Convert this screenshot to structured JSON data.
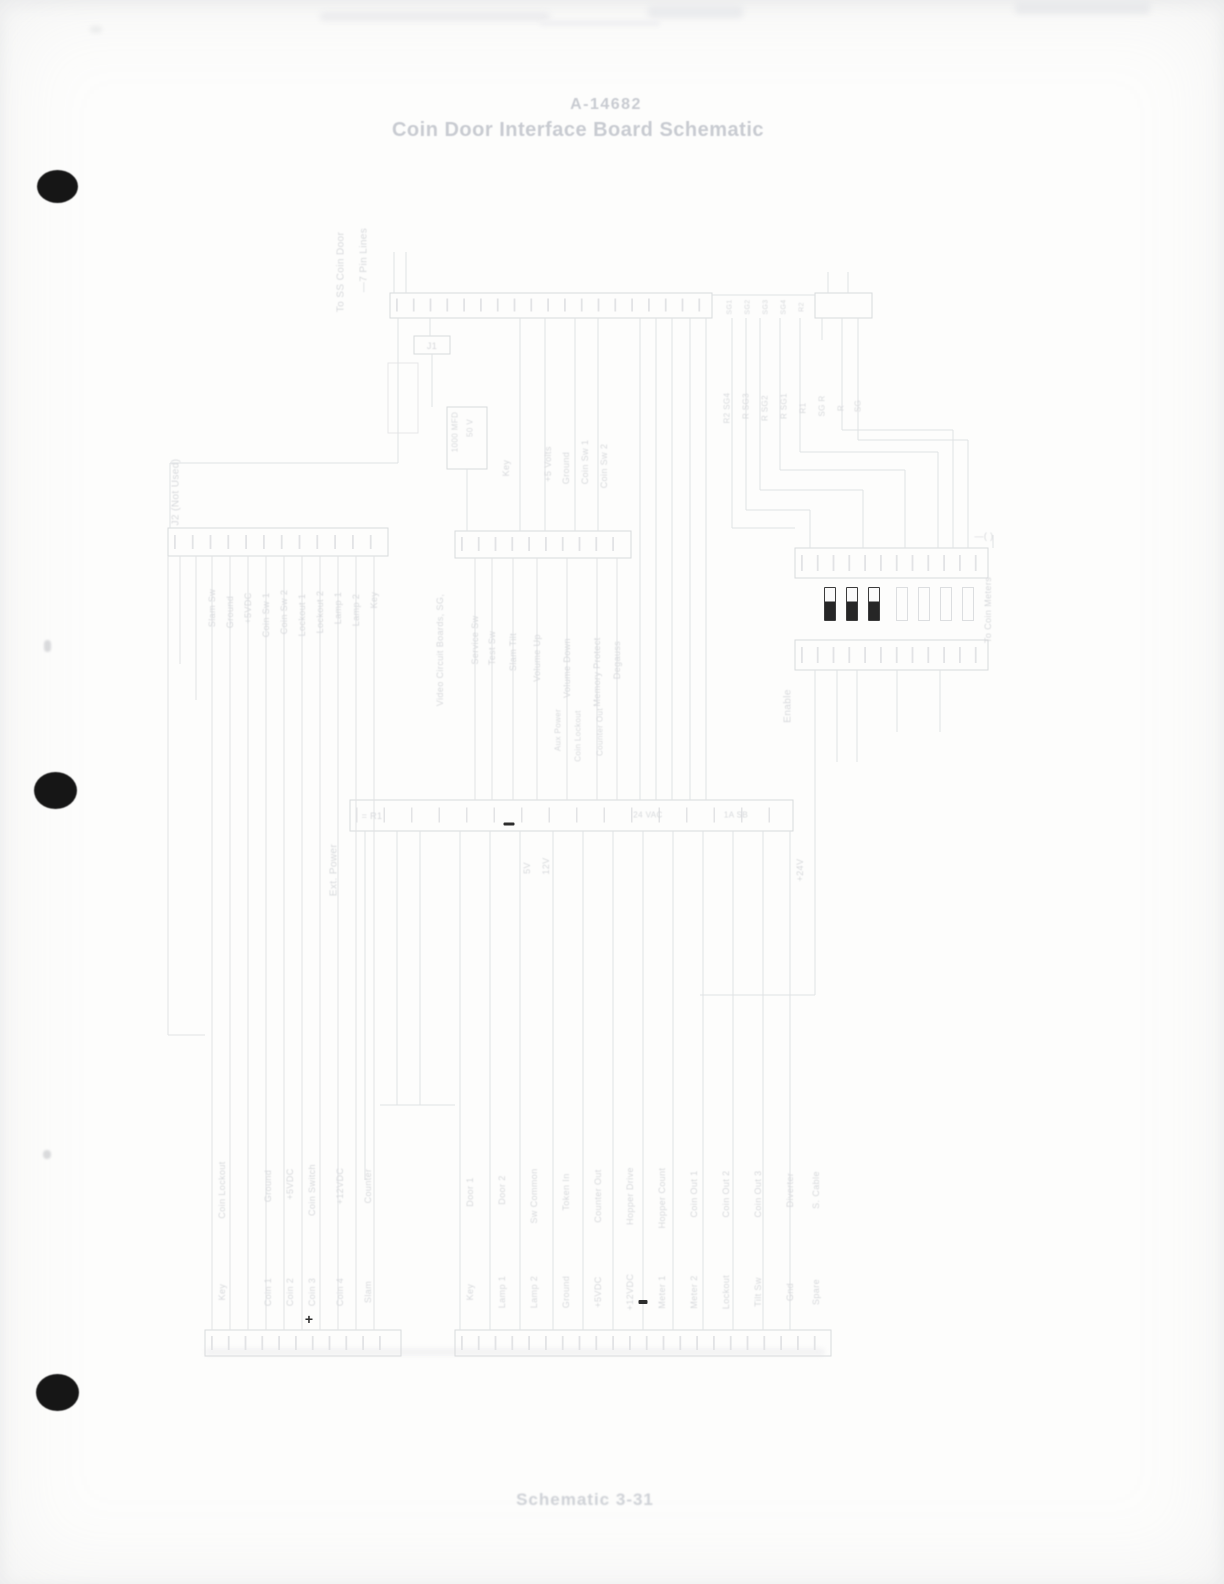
{
  "page": {
    "title_line1": "A-14682",
    "title_line2": "Coin Door Interface Board Schematic",
    "caption": "Schematic 3-31",
    "background_color": "#fdfdfc",
    "ink_color": "#dfe1e3",
    "title_color": "#c8cbd1",
    "dark_mark_color": "#2d2d2d",
    "punch_hole_color": "#161616",
    "punch_hole_count": 3
  },
  "schematic": {
    "note": "very faint scanned connector-wiring schematic, rotated wire labels",
    "jumpers": {
      "y": 587,
      "w": 10,
      "h": 32,
      "filled": [
        {
          "x": 824
        },
        {
          "x": 846
        },
        {
          "x": 868
        }
      ],
      "empty": [
        {
          "x": 896
        },
        {
          "x": 918
        },
        {
          "x": 940
        },
        {
          "x": 962
        }
      ]
    },
    "marks": [
      {
        "type": "plus",
        "x": 309,
        "y": 1319,
        "glyph": "+"
      },
      {
        "type": "dash",
        "x": 509,
        "y": 824,
        "w": 11,
        "h": 3
      },
      {
        "type": "dash",
        "x": 643,
        "y": 1302,
        "w": 9,
        "h": 4
      }
    ],
    "labels": [
      {
        "text": "To SS Coin Door",
        "x": 341,
        "y": 272,
        "size": 10
      },
      {
        "text": "—7 Pin Lines",
        "x": 364,
        "y": 260,
        "size": 10
      },
      {
        "text": "J1",
        "x": 432,
        "y": 346,
        "rot": false,
        "size": 9
      },
      {
        "text": "1000 MFD",
        "x": 455,
        "y": 432,
        "size": 8
      },
      {
        "text": "50 V",
        "x": 470,
        "y": 428,
        "size": 8
      },
      {
        "text": "Key",
        "x": 506,
        "y": 468,
        "size": 9
      },
      {
        "text": "+5 Volts",
        "x": 548,
        "y": 464,
        "size": 9
      },
      {
        "text": "Ground",
        "x": 566,
        "y": 468,
        "size": 9
      },
      {
        "text": "Coin Sw 1",
        "x": 585,
        "y": 462,
        "size": 9
      },
      {
        "text": "Coin Sw 2",
        "x": 604,
        "y": 466,
        "size": 9
      },
      {
        "text": "SG1",
        "x": 730,
        "y": 307,
        "size": 7
      },
      {
        "text": "SG2",
        "x": 748,
        "y": 307,
        "size": 7
      },
      {
        "text": "SG3",
        "x": 766,
        "y": 307,
        "size": 7
      },
      {
        "text": "SG4",
        "x": 784,
        "y": 307,
        "size": 7
      },
      {
        "text": "R2",
        "x": 802,
        "y": 307,
        "size": 7
      },
      {
        "text": "R2 SG4",
        "x": 727,
        "y": 408,
        "size": 8
      },
      {
        "text": "R SG3",
        "x": 746,
        "y": 406,
        "size": 8
      },
      {
        "text": "R SG2",
        "x": 765,
        "y": 408,
        "size": 8
      },
      {
        "text": "R SG1",
        "x": 784,
        "y": 406,
        "size": 8
      },
      {
        "text": "R1",
        "x": 803,
        "y": 408,
        "size": 8
      },
      {
        "text": "SG R",
        "x": 822,
        "y": 406,
        "size": 8
      },
      {
        "text": "R",
        "x": 841,
        "y": 408,
        "size": 8
      },
      {
        "text": "SG",
        "x": 858,
        "y": 406,
        "size": 8
      },
      {
        "text": "J2 (Not Used)",
        "x": 176,
        "y": 492,
        "size": 10
      },
      {
        "text": "Slam Sw",
        "x": 212,
        "y": 608,
        "size": 9
      },
      {
        "text": "Ground",
        "x": 230,
        "y": 612,
        "size": 9
      },
      {
        "text": "+5VDC",
        "x": 248,
        "y": 608,
        "size": 9
      },
      {
        "text": "Coin Sw 1",
        "x": 266,
        "y": 615,
        "size": 9
      },
      {
        "text": "Coin Sw 2",
        "x": 284,
        "y": 612,
        "size": 9
      },
      {
        "text": "Lockout 1",
        "x": 302,
        "y": 615,
        "size": 9
      },
      {
        "text": "Lockout 2",
        "x": 320,
        "y": 612,
        "size": 9
      },
      {
        "text": "Lamp 1",
        "x": 338,
        "y": 608,
        "size": 9
      },
      {
        "text": "Lamp 2",
        "x": 356,
        "y": 610,
        "size": 9
      },
      {
        "text": "Key",
        "x": 374,
        "y": 600,
        "size": 9
      },
      {
        "text": "Video Circuit Boards, SG,",
        "x": 440,
        "y": 650,
        "size": 9
      },
      {
        "text": "Service Sw",
        "x": 475,
        "y": 640,
        "size": 9
      },
      {
        "text": "Test Sw",
        "x": 492,
        "y": 648,
        "size": 9
      },
      {
        "text": "Slam Tilt",
        "x": 513,
        "y": 652,
        "size": 9
      },
      {
        "text": "Volume Up",
        "x": 537,
        "y": 658,
        "size": 9
      },
      {
        "text": "Volume Down",
        "x": 567,
        "y": 668,
        "size": 9
      },
      {
        "text": "Memory Protect",
        "x": 597,
        "y": 672,
        "size": 9
      },
      {
        "text": "Degauss",
        "x": 617,
        "y": 660,
        "size": 9
      },
      {
        "text": "Aux Power",
        "x": 558,
        "y": 730,
        "size": 8
      },
      {
        "text": "Coin Lockout",
        "x": 578,
        "y": 736,
        "size": 8
      },
      {
        "text": "Counter Out",
        "x": 600,
        "y": 732,
        "size": 8
      },
      {
        "text": "To Coin Meters",
        "x": 988,
        "y": 610,
        "size": 9
      },
      {
        "text": "Enable",
        "x": 788,
        "y": 706,
        "size": 10
      },
      {
        "text": "—( )",
        "x": 984,
        "y": 536,
        "rot": false,
        "size": 9
      },
      {
        "text": "Ext. Power",
        "x": 334,
        "y": 870,
        "size": 10
      },
      {
        "text": "= R1",
        "x": 372,
        "y": 816,
        "rot": false,
        "size": 9
      },
      {
        "text": "24 VAC",
        "x": 648,
        "y": 815,
        "rot": false,
        "size": 8
      },
      {
        "text": "1A SB",
        "x": 736,
        "y": 815,
        "rot": false,
        "size": 8
      },
      {
        "text": "5V",
        "x": 527,
        "y": 868,
        "size": 9
      },
      {
        "text": "12V",
        "x": 546,
        "y": 866,
        "size": 9
      },
      {
        "text": "+24V",
        "x": 800,
        "y": 870,
        "size": 9
      },
      {
        "text": "Coin Lockout",
        "x": 222,
        "y": 1190,
        "size": 9
      },
      {
        "text": "Ground",
        "x": 268,
        "y": 1186,
        "size": 9
      },
      {
        "text": "+5VDC",
        "x": 290,
        "y": 1184,
        "size": 9
      },
      {
        "text": "Coin Switch",
        "x": 312,
        "y": 1190,
        "size": 9
      },
      {
        "text": "+12VDC",
        "x": 340,
        "y": 1186,
        "size": 9
      },
      {
        "text": "Counter",
        "x": 368,
        "y": 1186,
        "size": 9
      },
      {
        "text": "Key",
        "x": 222,
        "y": 1292,
        "size": 9
      },
      {
        "text": "Coin 1",
        "x": 268,
        "y": 1292,
        "size": 9
      },
      {
        "text": "Coin 2",
        "x": 290,
        "y": 1292,
        "size": 9
      },
      {
        "text": "Coin 3",
        "x": 312,
        "y": 1292,
        "size": 9
      },
      {
        "text": "Coin 4",
        "x": 340,
        "y": 1292,
        "size": 9
      },
      {
        "text": "Slam",
        "x": 368,
        "y": 1292,
        "size": 9
      },
      {
        "text": "Door 1",
        "x": 470,
        "y": 1192,
        "size": 9
      },
      {
        "text": "Door 2",
        "x": 502,
        "y": 1190,
        "size": 9
      },
      {
        "text": "Sw Common",
        "x": 534,
        "y": 1196,
        "size": 9
      },
      {
        "text": "Token In",
        "x": 566,
        "y": 1192,
        "size": 9
      },
      {
        "text": "Counter Out",
        "x": 598,
        "y": 1196,
        "size": 9
      },
      {
        "text": "Hopper Drive",
        "x": 630,
        "y": 1196,
        "size": 9
      },
      {
        "text": "Hopper Count",
        "x": 662,
        "y": 1198,
        "size": 9
      },
      {
        "text": "Coin Out 1",
        "x": 694,
        "y": 1194,
        "size": 9
      },
      {
        "text": "Coin Out 2",
        "x": 726,
        "y": 1194,
        "size": 9
      },
      {
        "text": "Coin Out 3",
        "x": 758,
        "y": 1194,
        "size": 9
      },
      {
        "text": "Diverter",
        "x": 790,
        "y": 1190,
        "size": 9
      },
      {
        "text": "S. Cable",
        "x": 816,
        "y": 1190,
        "size": 9
      },
      {
        "text": "Key",
        "x": 470,
        "y": 1292,
        "size": 9
      },
      {
        "text": "Lamp 1",
        "x": 502,
        "y": 1292,
        "size": 9
      },
      {
        "text": "Lamp 2",
        "x": 534,
        "y": 1292,
        "size": 9
      },
      {
        "text": "Ground",
        "x": 566,
        "y": 1292,
        "size": 9
      },
      {
        "text": "+5VDC",
        "x": 598,
        "y": 1292,
        "size": 9
      },
      {
        "text": "+12VDC",
        "x": 630,
        "y": 1292,
        "size": 9
      },
      {
        "text": "Meter 1",
        "x": 662,
        "y": 1292,
        "size": 9
      },
      {
        "text": "Meter 2",
        "x": 694,
        "y": 1292,
        "size": 9
      },
      {
        "text": "Lockout",
        "x": 726,
        "y": 1292,
        "size": 9
      },
      {
        "text": "Tilt Sw",
        "x": 758,
        "y": 1292,
        "size": 9
      },
      {
        "text": "Gnd",
        "x": 790,
        "y": 1292,
        "size": 9
      },
      {
        "text": "Spare",
        "x": 816,
        "y": 1292,
        "size": 9
      }
    ]
  }
}
